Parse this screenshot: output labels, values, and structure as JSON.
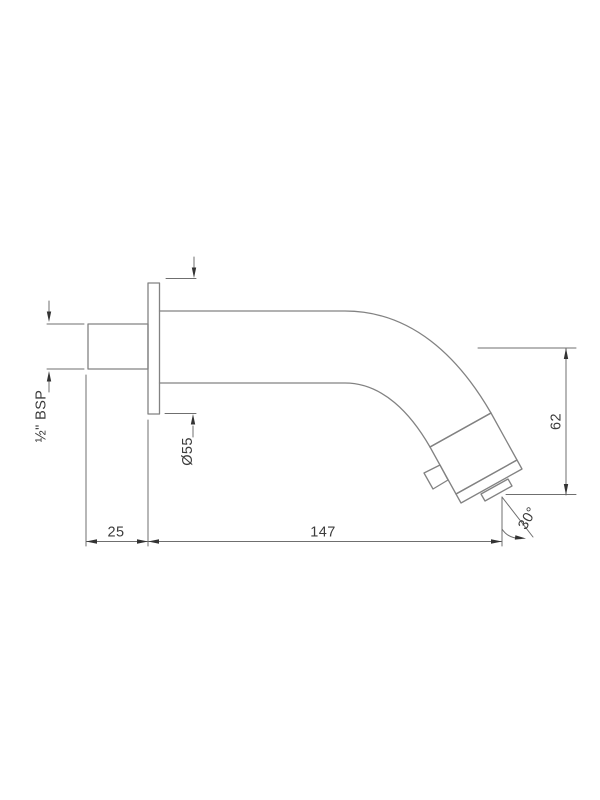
{
  "page": {
    "background": "#ffffff"
  },
  "drawing": {
    "line_color": "#828282",
    "dim_color": "#6f6f6f",
    "arrow_color": "#333333",
    "text_color": "#3c3c3c",
    "labels": {
      "thread": "½\" BSP",
      "flange_diameter": "Ø55",
      "wall_offset": "25",
      "reach": "147",
      "height": "62",
      "angle": "30°"
    }
  }
}
